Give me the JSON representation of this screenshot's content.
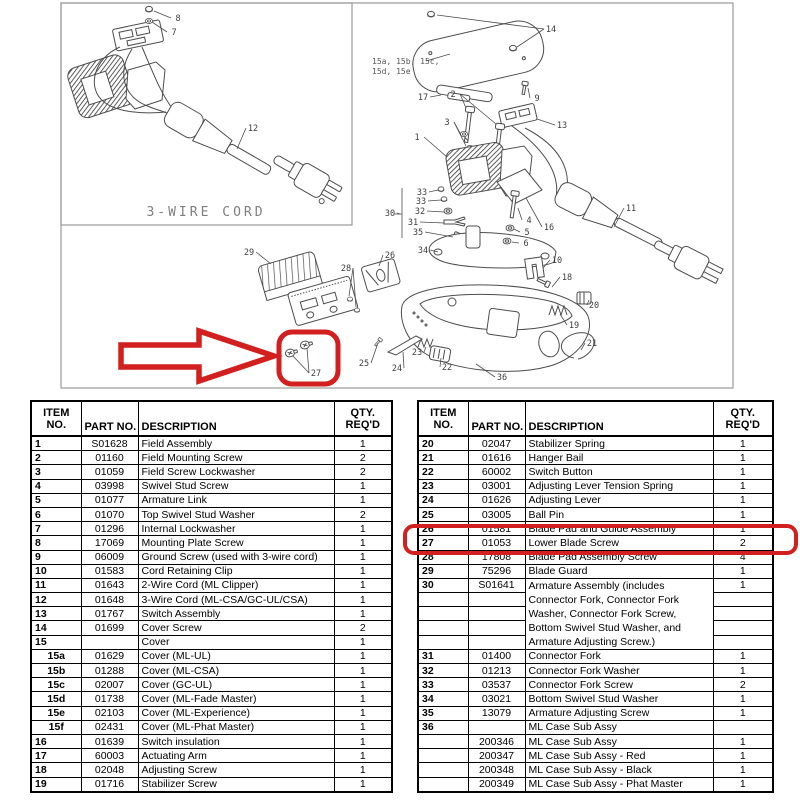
{
  "colors": {
    "highlight_red": "#d21f1f",
    "drawing_line": "#4d4d4d",
    "box_border": "#9a9a9a"
  },
  "diagram": {
    "inset_label": "3-WIRE CORD",
    "cover_variants": {
      "line1": "15a, 15b, 15c,",
      "line2": "15d, 15e"
    },
    "callouts": [
      {
        "t": "8",
        "x": 178,
        "y": 21,
        "lx": 154,
        "ly": 11
      },
      {
        "t": "7",
        "x": 174,
        "y": 35,
        "lx": 152,
        "ly": 22
      },
      {
        "t": "12",
        "x": 253,
        "y": 131,
        "lx": 237,
        "ly": 149
      },
      {
        "t": "14",
        "x": 551,
        "y": 32,
        "lx": 437,
        "ly": 15,
        "l2x": 517,
        "l2y": 47
      },
      {
        "t": "17",
        "x": 423,
        "y": 100,
        "lx": 441,
        "ly": 95
      },
      {
        "t": "2",
        "x": 453,
        "y": 97,
        "lx": 466,
        "ly": 108,
        "l2x": 496,
        "l2y": 124
      },
      {
        "t": "9",
        "x": 537,
        "y": 101,
        "lx": 528,
        "ly": 88
      },
      {
        "t": "13",
        "x": 562,
        "y": 128,
        "lx": 537,
        "ly": 119
      },
      {
        "t": "3",
        "x": 447,
        "y": 125,
        "lx": 460,
        "ly": 133,
        "l2x": 466,
        "l2y": 146
      },
      {
        "t": "1",
        "x": 417,
        "y": 140,
        "lx": 447,
        "ly": 157
      },
      {
        "t": "16",
        "x": 549,
        "y": 230,
        "lx": 526,
        "ly": 198
      },
      {
        "t": "11",
        "x": 631,
        "y": 211,
        "lx": 614,
        "ly": 227
      },
      {
        "t": "30",
        "x": 390,
        "y": 216,
        "lx": 400,
        "ly": 214
      },
      {
        "t": "33",
        "x": 422,
        "y": 195,
        "lx": 438,
        "ly": 190
      },
      {
        "t": "33",
        "x": 421,
        "y": 204,
        "lx": 441,
        "ly": 200
      },
      {
        "t": "32",
        "x": 420,
        "y": 214,
        "lx": 444,
        "ly": 212
      },
      {
        "t": "31",
        "x": 413,
        "y": 225,
        "lx": 444,
        "ly": 223
      },
      {
        "t": "35",
        "x": 418,
        "y": 235,
        "lx": 453,
        "ly": 237
      },
      {
        "t": "34",
        "x": 423,
        "y": 253,
        "lx": 438,
        "ly": 252
      },
      {
        "t": "4",
        "x": 529,
        "y": 223,
        "lx": 518,
        "ly": 208
      },
      {
        "t": "5",
        "x": 527,
        "y": 235,
        "lx": 514,
        "ly": 229
      },
      {
        "t": "6",
        "x": 526,
        "y": 246,
        "lx": 512,
        "ly": 242
      },
      {
        "t": "10",
        "x": 557,
        "y": 263,
        "lx": 543,
        "ly": 268
      },
      {
        "t": "18",
        "x": 567,
        "y": 280,
        "lx": 552,
        "ly": 287
      },
      {
        "t": "20",
        "x": 594,
        "y": 308,
        "lx": 589,
        "ly": 300
      },
      {
        "t": "19",
        "x": 574,
        "y": 328,
        "lx": 560,
        "ly": 314
      },
      {
        "t": "21",
        "x": 592,
        "y": 346,
        "lx": 581,
        "ly": 350
      },
      {
        "t": "22",
        "x": 447,
        "y": 370,
        "lx": 441,
        "ly": 358
      },
      {
        "t": "23",
        "x": 417,
        "y": 355,
        "lx": 426,
        "ly": 347
      },
      {
        "t": "24",
        "x": 397,
        "y": 371,
        "lx": 403,
        "ly": 352
      },
      {
        "t": "25",
        "x": 364,
        "y": 366,
        "lx": 378,
        "ly": 343
      },
      {
        "t": "36",
        "x": 502,
        "y": 380,
        "lx": 476,
        "ly": 364
      },
      {
        "t": "29",
        "x": 249,
        "y": 255,
        "lx": 271,
        "ly": 264
      },
      {
        "t": "28",
        "x": 346,
        "y": 271,
        "lx": 349,
        "ly": 296,
        "l2x": 356,
        "l2y": 307
      },
      {
        "t": "26",
        "x": 390,
        "y": 258,
        "lx": 379,
        "ly": 266
      },
      {
        "t": "27",
        "x": 316,
        "y": 376,
        "lx": 293,
        "ly": 356,
        "l2x": 307,
        "l2y": 348
      }
    ]
  },
  "tables": {
    "headers": {
      "item1": "ITEM",
      "item2": "NO.",
      "part": "PART NO.",
      "desc": "DESCRIPTION",
      "qty1": "QTY.",
      "qty2": "REQ'D"
    },
    "left": {
      "rows": [
        {
          "i": "1",
          "p": "S01628",
          "d": "Field Assembly",
          "q": "1"
        },
        {
          "i": "2",
          "p": "01160",
          "d": "Field Mounting Screw",
          "q": "2"
        },
        {
          "i": "3",
          "p": "01059",
          "d": "Field Screw Lockwasher",
          "q": "2"
        },
        {
          "i": "4",
          "p": "03998",
          "d": "Swivel Stud Screw",
          "q": "1"
        },
        {
          "i": "5",
          "p": "01077",
          "d": "Armature Link",
          "q": "1"
        },
        {
          "i": "6",
          "p": "01070",
          "d": "Top Swivel Stud Washer",
          "q": "2"
        },
        {
          "i": "7",
          "p": "01296",
          "d": "Internal Lockwasher",
          "q": "1"
        },
        {
          "i": "8",
          "p": "17069",
          "d": "Mounting Plate Screw",
          "q": "1"
        },
        {
          "i": "9",
          "p": "06009",
          "d": "Ground Screw (used with 3-wire cord)",
          "q": "1"
        },
        {
          "i": "10",
          "p": "01583",
          "d": "Cord Retaining Clip",
          "q": "1"
        },
        {
          "i": "11",
          "p": "01643",
          "d": "2-Wire Cord (ML Clipper)",
          "q": "1"
        },
        {
          "i": "12",
          "p": "01648",
          "d": "3-Wire Cord (ML-CSA/GC-UL/CSA)",
          "q": "1"
        },
        {
          "i": "13",
          "p": "01767",
          "d": "Switch Assembly",
          "q": "1"
        },
        {
          "i": "14",
          "p": "01699",
          "d": "Cover Screw",
          "q": "2"
        },
        {
          "i": "15",
          "p": "",
          "d": "Cover",
          "q": "1"
        },
        {
          "i": "15a",
          "p": "01629",
          "d": "Cover (ML-UL)",
          "q": "1",
          "sub": true
        },
        {
          "i": "15b",
          "p": "01288",
          "d": "Cover (ML-CSA)",
          "q": "1",
          "sub": true
        },
        {
          "i": "15c",
          "p": "02007",
          "d": "Cover (GC-UL)",
          "q": "1",
          "sub": true
        },
        {
          "i": "15d",
          "p": "01738",
          "d": "Cover (ML-Fade Master)",
          "q": "1",
          "sub": true
        },
        {
          "i": "15e",
          "p": "02103",
          "d": "Cover (ML-Experience)",
          "q": "1",
          "sub": true
        },
        {
          "i": "15f",
          "p": "02431",
          "d": "Cover (ML-Phat Master)",
          "q": "1",
          "sub": true
        },
        {
          "i": "16",
          "p": "01639",
          "d": "Switch insulation",
          "q": "1"
        },
        {
          "i": "17",
          "p": "60003",
          "d": "Actuating Arm",
          "q": "1"
        },
        {
          "i": "18",
          "p": "02048",
          "d": "Adjusting Screw",
          "q": "1"
        },
        {
          "i": "19",
          "p": "01716",
          "d": "Stabilizer Screw",
          "q": "1"
        }
      ]
    },
    "right": {
      "highlighted_item": "27",
      "rows": [
        {
          "i": "20",
          "p": "02047",
          "d": "Stabilizer Spring",
          "q": "1"
        },
        {
          "i": "21",
          "p": "01616",
          "d": "Hanger Bail",
          "q": "1"
        },
        {
          "i": "22",
          "p": "60002",
          "d": "Switch Button",
          "q": "1"
        },
        {
          "i": "23",
          "p": "03001",
          "d": "Adjusting Lever Tension Spring",
          "q": "1"
        },
        {
          "i": "24",
          "p": "01626",
          "d": "Adjusting Lever",
          "q": "1"
        },
        {
          "i": "25",
          "p": "03005",
          "d": "Ball Pin",
          "q": "1"
        },
        {
          "i": "26",
          "p": "01581",
          "d": "Blade Pad and Guide Assembly",
          "q": "1"
        },
        {
          "i": "27",
          "p": "01053",
          "d": "Lower Blade Screw",
          "q": "2"
        },
        {
          "i": "28",
          "p": "17808",
          "d": "Blade Pad Assembly Screw",
          "q": "4"
        },
        {
          "i": "29",
          "p": "75296",
          "d": "Blade Guard",
          "q": "1"
        },
        {
          "i": "30",
          "p": "S01641",
          "d": "Armature Assembly (includes",
          "q": "1",
          "dnb": true
        },
        {
          "i": "",
          "p": "",
          "d": "Connector Fork, Connector Fork",
          "q": "",
          "dnb": true
        },
        {
          "i": "",
          "p": "",
          "d": "Washer, Connector Fork Screw,",
          "q": "",
          "dnb": true
        },
        {
          "i": "",
          "p": "",
          "d": "Bottom Swivel Stud Washer, and",
          "q": "",
          "dnb": true
        },
        {
          "i": "",
          "p": "",
          "d": "Armature Adjusting Screw.)",
          "q": ""
        },
        {
          "i": "31",
          "p": "01400",
          "d": "Connector Fork",
          "q": "1"
        },
        {
          "i": "32",
          "p": "01213",
          "d": "Connector Fork Washer",
          "q": "1"
        },
        {
          "i": "33",
          "p": "03537",
          "d": "Connector Fork Screw",
          "q": "2"
        },
        {
          "i": "34",
          "p": "03021",
          "d": "Bottom Swivel Stud Washer",
          "q": "1"
        },
        {
          "i": "35",
          "p": "13079",
          "d": "Armature Adjusting Screw",
          "q": "1"
        },
        {
          "i": "36",
          "p": "",
          "d": "ML Case Sub Assy",
          "q": ""
        },
        {
          "i": "",
          "p": "200346",
          "d": "ML Case Sub Assy",
          "q": "1"
        },
        {
          "i": "",
          "p": "200347",
          "d": "ML Case Sub Assy - Red",
          "q": "1"
        },
        {
          "i": "",
          "p": "200348",
          "d": "ML Case Sub Assy - Black",
          "q": "1"
        },
        {
          "i": "",
          "p": "200349",
          "d": "ML Case Sub Assy - Phat Master",
          "q": "1"
        }
      ]
    }
  }
}
